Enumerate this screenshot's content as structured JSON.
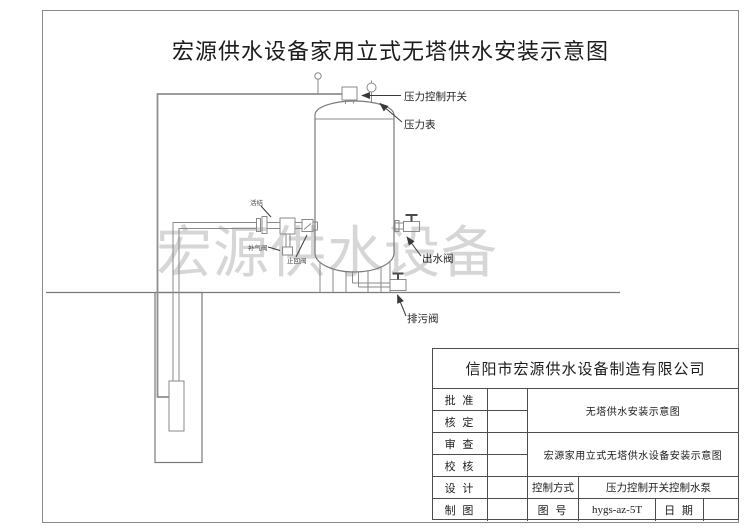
{
  "page": {
    "title": "宏源供水设备家用立式无塔供水安装示意图",
    "watermark": "宏源供水设备"
  },
  "diagram_labels": {
    "pressure_switch": "压力控制开关",
    "pressure_gauge": "压力表",
    "union": "活结",
    "air_valve": "补气阀",
    "check_valve": "止回阀",
    "outlet_valve": "出水阀",
    "drain_valve": "排污阀"
  },
  "title_block": {
    "company": "信阳市宏源供水设备制造有限公司",
    "approve_label": "批 准",
    "verify_label": "核 定",
    "review_label": "审 查",
    "proof_label": "校 核",
    "design_label": "设 计",
    "draft_label": "制 图",
    "drawing_name": "无塔供水安装示意图",
    "drawing_full_name": "宏源家用立式无塔供水设备安装示意图",
    "control_mode_label": "控制方式",
    "control_mode_value": "压力控制开关控制水泵",
    "drawing_no_label": "图 号",
    "drawing_no_value": "hygs-az-5T",
    "date_label": "日 期"
  },
  "colors": {
    "line": "#7a7a7a",
    "watermark": "#d6d6d6",
    "text": "#1c1c1c"
  }
}
